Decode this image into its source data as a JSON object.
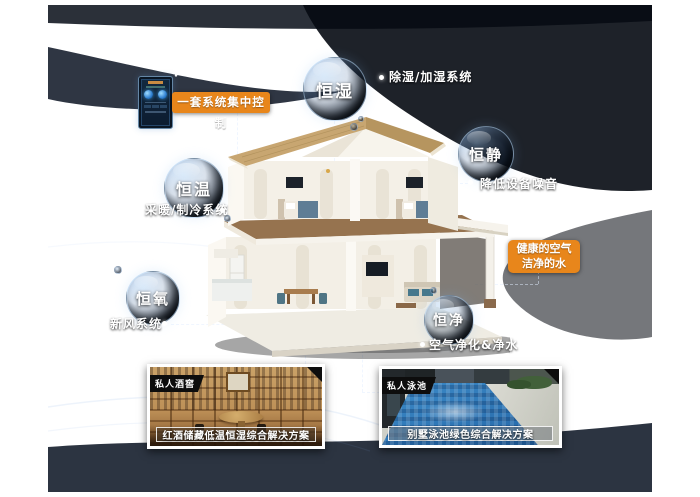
{
  "colors": {
    "accent_orange": "#E8861B",
    "canvas_navy": "#16263F"
  },
  "control_label": "一套系统集中控制",
  "bubbles": [
    {
      "label": "恒湿",
      "note": "除湿/加湿系统"
    },
    {
      "label": "恒静",
      "note": "降低设备噪音"
    },
    {
      "label": "恒温",
      "note": "采暖/制冷系统"
    },
    {
      "label": "恒氧",
      "note": "新风系统"
    },
    {
      "label": "恒净",
      "note": "空气净化&净水"
    }
  ],
  "highlight_box": {
    "line1": "健康的空气",
    "line2": "洁净的水"
  },
  "cards": [
    {
      "tag": "私人酒窖",
      "caption": "红酒储藏低温恒湿综合解决方案"
    },
    {
      "tag": "私人泳池",
      "caption": "别墅泳池绿色综合解决方案"
    }
  ]
}
